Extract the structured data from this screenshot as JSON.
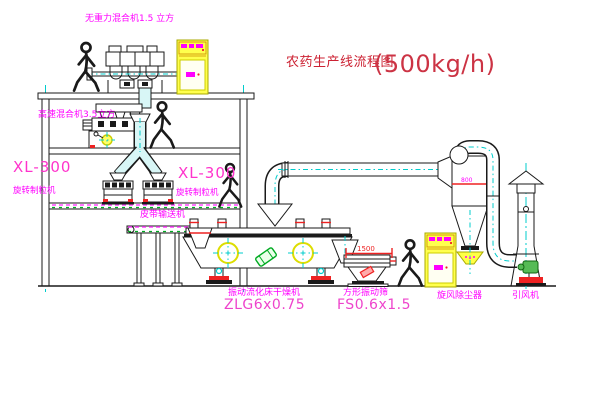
{
  "title": {
    "name_zh": "农药生产线流程图",
    "capacity": "(500kg/h)"
  },
  "equipment_labels": {
    "rooftop_mixer": "无重力混合机1.5 立方",
    "high_speed_mixer": "高速混合机3.5立方",
    "granulator_left": {
      "model": "XL-300",
      "name": "旋转制粒机"
    },
    "granulator_right": {
      "model": "XL-300",
      "name": "旋转制粒机"
    },
    "belt_conveyor": "皮带输送机",
    "fluid_bed_dryer": {
      "name": "振动流化床干燥机",
      "model": "ZLG6x0.75"
    },
    "vibrating_screen": {
      "name": "方形振动筛",
      "model": "FS0.6x1.5"
    },
    "cyclone": "旋风除尘器",
    "induced_draft_fan": "引风机"
  },
  "dimensions": {
    "screen_width": "1500",
    "cyclone_diameter": "800"
  },
  "colors": {
    "label_magenta": "#ff00ff",
    "model_pink": "#ee44cc",
    "title_red": "#cc2233",
    "centerline_cyan": "#00cccc",
    "cabinet_yellow": "#ffff4d",
    "accent_red": "#ee2222",
    "motor_green": "#55bb55",
    "drawing_black": "#1a1a1a"
  }
}
